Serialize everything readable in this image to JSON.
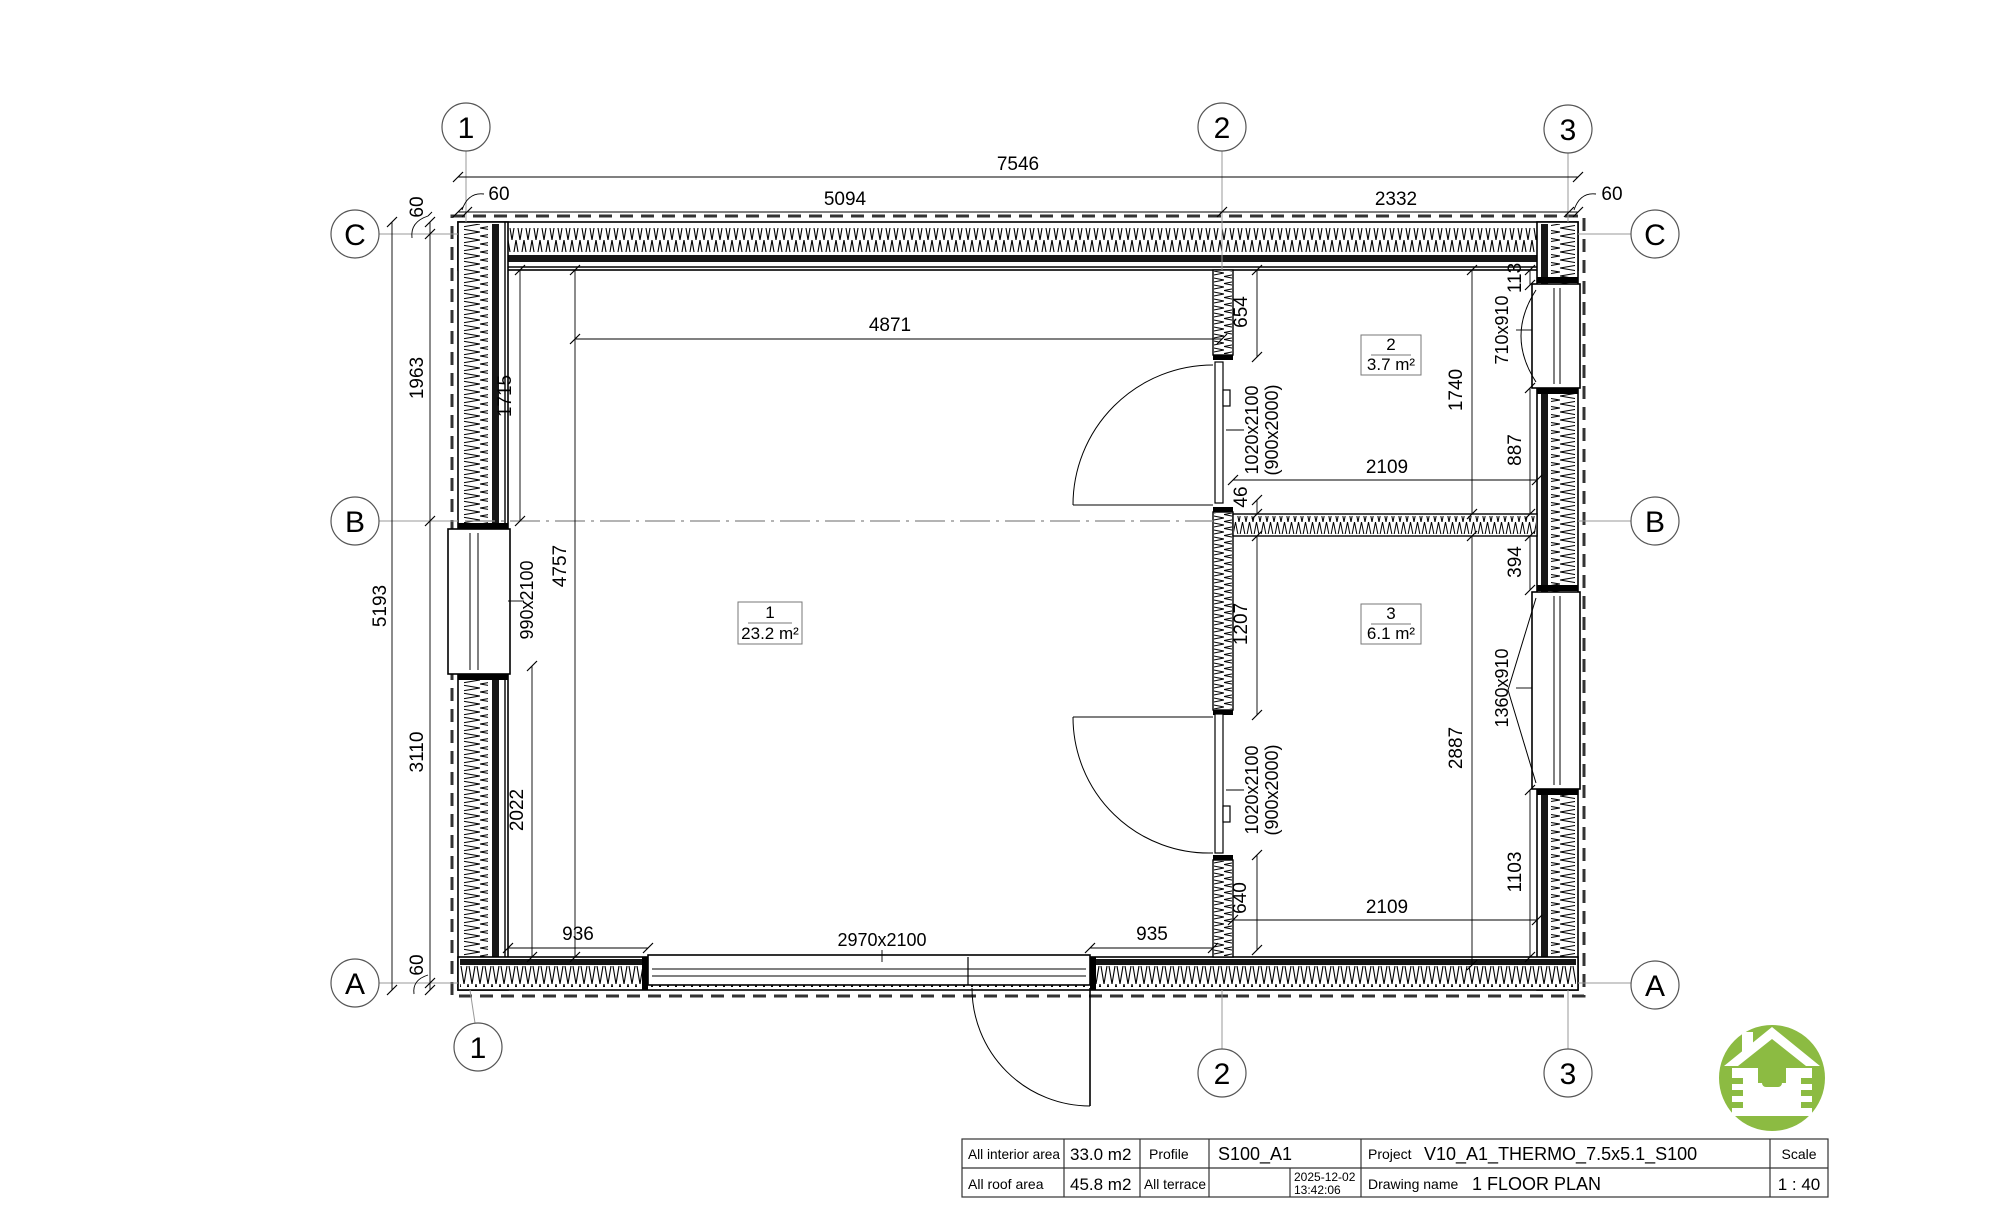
{
  "drawing_title": "1 FLOOR PLAN",
  "grid": {
    "top": [
      "1",
      "2",
      "3"
    ],
    "bottom": [
      "1",
      "2",
      "3"
    ],
    "left": [
      "C",
      "B",
      "A"
    ],
    "right": [
      "C",
      "B",
      "A"
    ]
  },
  "dims": {
    "total_width": "7546",
    "offset_left": "60",
    "span_12": "5094",
    "span_23": "2332",
    "offset_right": "60",
    "total_height": "5193",
    "offset_top": "60",
    "span_cb": "1963",
    "span_ba": "3110",
    "offset_bottom": "60",
    "room1_top": "4871",
    "room1_upper_left": "1715",
    "room1_height": "4757",
    "room1_lower_left": "2022",
    "left_window": "990x2100",
    "bottom_left": "936",
    "bottom_door": "2970x2100",
    "bottom_right": "935",
    "wall2_upper": "654",
    "door1_size": "1020x2100",
    "door1_alt": "(900x2000)",
    "gap46": "46",
    "room2_width": "2109",
    "room2_height": "1740",
    "win2_offset": "113",
    "win2_size": "710x910",
    "win2_below": "887",
    "room3_offset": "394",
    "win3_size": "1360x910",
    "room3_height": "2887",
    "win3_below": "1103",
    "wall2_mid": "1207",
    "door2_size": "1020x2100",
    "door2_alt": "(900x2000)",
    "wall2_lower": "640",
    "room3_width": "2109"
  },
  "rooms": [
    {
      "number": "1",
      "area": "23.2 m²"
    },
    {
      "number": "2",
      "area": "3.7 m²"
    },
    {
      "number": "3",
      "area": "6.1 m²"
    }
  ],
  "title_block": {
    "interior_area_label": "All interior area",
    "interior_area_value": "33.0 m2",
    "roof_area_label": "All roof area",
    "roof_area_value": "45.8 m2",
    "profile_label": "Profile",
    "profile_value": "S100_A1",
    "terrace_label": "All terrace",
    "date": "2025-12-02",
    "time": "13:42:06",
    "project_label": "Project",
    "project_value": "V10_A1_THERMO_7.5x5.1_S100",
    "drawing_name_label": "Drawing name",
    "drawing_name_value": "1 FLOOR PLAN",
    "scale_label": "Scale",
    "scale_value": "1 : 40"
  },
  "logo_color": "#8cbb42"
}
